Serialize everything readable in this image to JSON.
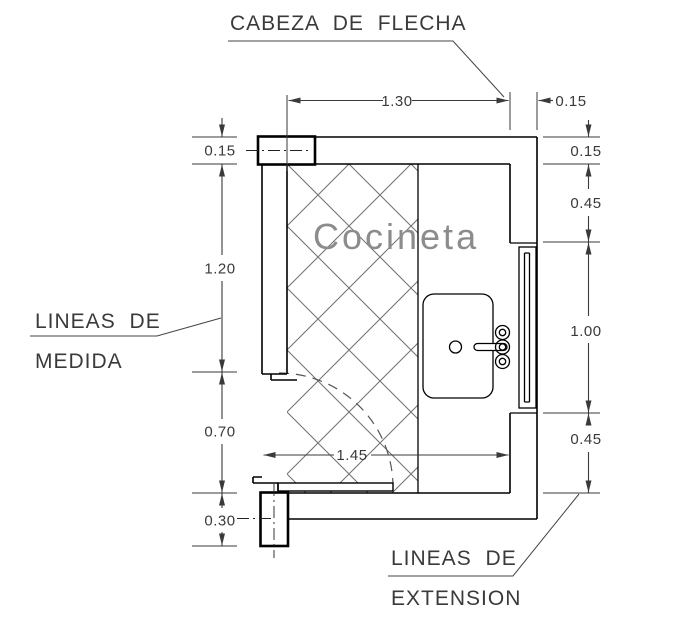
{
  "room": {
    "name": "Cocineta"
  },
  "annotations": {
    "arrowhead_label": "CABEZA DE FLECHA",
    "measure_label_line1": "LINEAS DE",
    "measure_label_line2": "MEDIDA",
    "extension_label_line1": "LINEAS DE",
    "extension_label_line2": "EXTENSION"
  },
  "dimensions": {
    "top_width": "1.30",
    "top_right_wall": "0.15",
    "left_wall_thickness": "0.15",
    "left_upper_height": "1.20",
    "left_door_opening": "0.70",
    "left_column": "0.30",
    "right_wall_thickness": "0.15",
    "right_upper": "0.45",
    "right_window": "1.00",
    "right_lower": "0.45",
    "inner_width": "1.45"
  },
  "colors": {
    "wall_line": "#000000",
    "dimension_line": "#3a3a3a",
    "hatch_line": "#6f6f6f",
    "room_label": "#8c8c8c",
    "background": "#ffffff"
  }
}
